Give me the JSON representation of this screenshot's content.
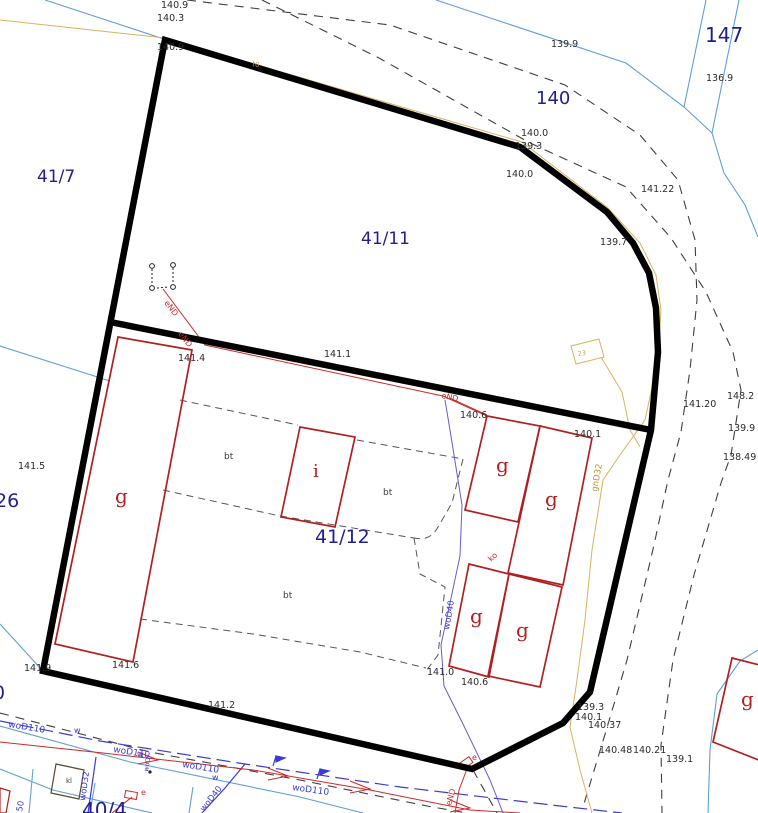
{
  "map": {
    "canvas": {
      "width": 758,
      "height": 813,
      "background": "#ffffff"
    },
    "colors": {
      "parcel_number": "#1f1f8f",
      "elevation": "#2b2b2b",
      "building": "#b02020",
      "boundary": "#000000",
      "water": "#3b3bcf",
      "power": "#cc2a2a",
      "gas": "#c9a14e",
      "parcel_line": "#5f9fd6",
      "road_dash": "#3f3f3f",
      "water_conn": "#6a5acd"
    },
    "labels": {
      "parcels": [
        {
          "t": "41/7",
          "x": 37,
          "y": 182,
          "s": 17
        },
        {
          "t": "140",
          "x": 536,
          "y": 104,
          "s": 18
        },
        {
          "t": "147",
          "x": 705,
          "y": 42,
          "s": 20
        },
        {
          "t": "41/11",
          "x": 361,
          "y": 244,
          "s": 17
        },
        {
          "t": "41/12",
          "x": 315,
          "y": 543,
          "s": 19
        },
        {
          "t": "26",
          "x": -5,
          "y": 507,
          "s": 19
        },
        {
          "t": "0",
          "x": -7,
          "y": 699,
          "s": 19
        },
        {
          "t": "40/4",
          "x": 82,
          "y": 817,
          "s": 20
        }
      ],
      "elevations": [
        {
          "t": "140.9",
          "x": 161,
          "y": 8
        },
        {
          "t": "140.3",
          "x": 157,
          "y": 21
        },
        {
          "t": "140.9",
          "x": 157,
          "y": 50
        },
        {
          "t": "139.9",
          "x": 551,
          "y": 47
        },
        {
          "t": "136.9",
          "x": 706,
          "y": 81
        },
        {
          "t": "140.0",
          "x": 521,
          "y": 136
        },
        {
          "t": "139.3",
          "x": 515,
          "y": 149
        },
        {
          "t": "140.0",
          "x": 506,
          "y": 177
        },
        {
          "t": "141.22",
          "x": 641,
          "y": 192
        },
        {
          "t": "139.7",
          "x": 600,
          "y": 245
        },
        {
          "t": "141.4",
          "x": 178,
          "y": 361
        },
        {
          "t": "141.1",
          "x": 324,
          "y": 357
        },
        {
          "t": "140.6",
          "x": 460,
          "y": 418
        },
        {
          "t": "140.1",
          "x": 574,
          "y": 437
        },
        {
          "t": "141.20",
          "x": 683,
          "y": 407
        },
        {
          "t": "148.2",
          "x": 727,
          "y": 399
        },
        {
          "t": "139.9",
          "x": 728,
          "y": 431
        },
        {
          "t": "138.49",
          "x": 723,
          "y": 460
        },
        {
          "t": "141.5",
          "x": 18,
          "y": 469
        },
        {
          "t": "141.9",
          "x": 24,
          "y": 671
        },
        {
          "t": "141.6",
          "x": 112,
          "y": 668
        },
        {
          "t": "141.2",
          "x": 208,
          "y": 708
        },
        {
          "t": "141.0",
          "x": 427,
          "y": 675
        },
        {
          "t": "140.6",
          "x": 461,
          "y": 685
        },
        {
          "t": "139.3",
          "x": 577,
          "y": 710
        },
        {
          "t": "140.1",
          "x": 575,
          "y": 720
        },
        {
          "t": "140.37",
          "x": 588,
          "y": 728
        },
        {
          "t": "140.48",
          "x": 599,
          "y": 753
        },
        {
          "t": "140.21",
          "x": 633,
          "y": 753
        },
        {
          "t": "139.1",
          "x": 666,
          "y": 762
        }
      ],
      "buildings": [
        {
          "t": "g",
          "x": 115,
          "y": 503,
          "s": 20
        },
        {
          "t": "i",
          "x": 313,
          "y": 477,
          "s": 18
        },
        {
          "t": "g",
          "x": 496,
          "y": 472,
          "s": 20
        },
        {
          "t": "g",
          "x": 545,
          "y": 506,
          "s": 20
        },
        {
          "t": "g",
          "x": 470,
          "y": 623,
          "s": 20
        },
        {
          "t": "g",
          "x": 516,
          "y": 637,
          "s": 20
        },
        {
          "t": "g",
          "x": 741,
          "y": 706,
          "s": 20
        }
      ],
      "surfaces": [
        {
          "t": "bt",
          "x": 224,
          "y": 459,
          "s": 9
        },
        {
          "t": "bt",
          "x": 383,
          "y": 495,
          "s": 9
        },
        {
          "t": "bt",
          "x": 283,
          "y": 598,
          "s": 9
        },
        {
          "t": "kl",
          "x": 66,
          "y": 783,
          "s": 7
        }
      ],
      "utilities": [
        {
          "t": "eND",
          "x": 164,
          "y": 303,
          "r": 53,
          "s": 8,
          "c": "#cc2a2a"
        },
        {
          "t": "eND",
          "x": 178,
          "y": 334,
          "r": 53,
          "s": 8,
          "c": "#cc2a2a"
        },
        {
          "t": "eND",
          "x": 441,
          "y": 398,
          "r": 12,
          "s": 8,
          "c": "#cc2a2a"
        },
        {
          "t": "eND",
          "x": 451,
          "y": 806,
          "r": -75,
          "s": 8,
          "c": "#cc2a2a"
        },
        {
          "t": "woD110",
          "x": 8,
          "y": 727,
          "r": 9,
          "s": 9,
          "c": "#3b3bcf"
        },
        {
          "t": "woD110",
          "x": 113,
          "y": 752,
          "r": 9,
          "s": 9,
          "c": "#3b3bcf"
        },
        {
          "t": "woD110",
          "x": 182,
          "y": 767,
          "r": 9,
          "s": 9,
          "c": "#3b3bcf"
        },
        {
          "t": "woD110",
          "x": 292,
          "y": 790,
          "r": 8,
          "s": 9,
          "c": "#3b3bcf"
        },
        {
          "t": "woD32",
          "x": 85,
          "y": 801,
          "r": -82,
          "s": 8.5,
          "c": "#3b3bcf"
        },
        {
          "t": "woD40",
          "x": 449,
          "y": 630,
          "r": -80,
          "s": 8.5,
          "c": "#3b3bcf"
        },
        {
          "t": "woD40",
          "x": 204,
          "y": 812,
          "r": -52,
          "s": 8.5,
          "c": "#3b3bcf"
        },
        {
          "t": "woD",
          "x": 148,
          "y": 772,
          "r": -80,
          "s": 6.5,
          "c": "#3b3bcf"
        },
        {
          "t": "w",
          "x": 74,
          "y": 733,
          "s": 8,
          "c": "#3b3bcf"
        },
        {
          "t": "w",
          "x": 137,
          "y": 757,
          "s": 8,
          "c": "#3b3bcf"
        },
        {
          "t": "w",
          "x": 212,
          "y": 780,
          "s": 8,
          "c": "#3b3bcf"
        },
        {
          "t": "50",
          "x": 22,
          "y": 812,
          "r": -80,
          "s": 8.5,
          "c": "#3b3bcf"
        },
        {
          "t": "gnD32",
          "x": 597,
          "y": 492,
          "r": -80,
          "s": 8.5,
          "c": "#b8922f"
        },
        {
          "t": "t0",
          "x": 252,
          "y": 66,
          "r": 10,
          "s": 7,
          "c": "#d49a5a"
        },
        {
          "t": "23",
          "x": 578,
          "y": 356,
          "r": -8,
          "s": 6.5,
          "c": "#c9a14e"
        },
        {
          "t": "ko",
          "x": 491,
          "y": 562,
          "r": -42,
          "s": 8,
          "c": "#cc2a2a"
        },
        {
          "t": "e",
          "x": 472,
          "y": 760,
          "s": 8,
          "c": "#cc2a2a"
        },
        {
          "t": "e",
          "x": 141,
          "y": 795,
          "s": 8,
          "c": "#cc2a2a"
        }
      ]
    }
  }
}
